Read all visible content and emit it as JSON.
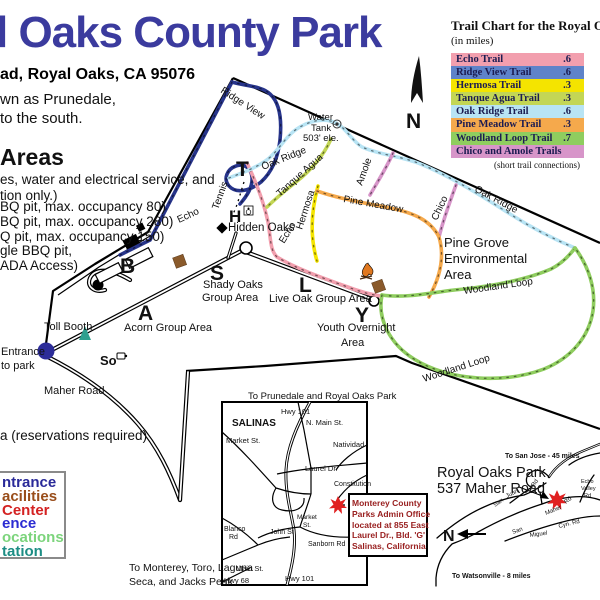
{
  "page": {
    "title": "l Oaks County Park",
    "address": "ad, Royal Oaks, CA 95076",
    "intro": [
      "wn as Prunedale,",
      "to the south."
    ],
    "areas_heading": "Areas",
    "areas_intro": [
      "es, water and electrical service, and",
      "tion only.)"
    ],
    "areas_items": [
      "BQ pit, max. occupancy 80)",
      "BQ pit, max. occupancy 280)",
      "Q pit, max. occupancy 150)",
      "gle BBQ pit,",
      "ADA Access)"
    ],
    "reservation_note": "a (reservations required)",
    "to_monterey": [
      "To Monterey, Toro, Laguna",
      "Seca, and Jacks Peak"
    ]
  },
  "trail_chart": {
    "title": "Trail Chart for the Royal Oak",
    "subtitle": "(in miles)",
    "rows": [
      {
        "name": "Echo Trail",
        "miles": ".6",
        "color": "#f29fae"
      },
      {
        "name": "Ridge View Trail",
        "miles": ".6",
        "color": "#5f83c9"
      },
      {
        "name": "Hermosa Trail",
        "miles": ".3",
        "color": "#f4e400"
      },
      {
        "name": "Tanque Agua Trail",
        "miles": ".3",
        "color": "#c3d655"
      },
      {
        "name": "Oak Ridge Trail",
        "miles": ".6",
        "color": "#b8e4f4"
      },
      {
        "name": "Pine Meadow Trail",
        "miles": ".3",
        "color": "#f5a94c"
      },
      {
        "name": "Woodland Loop Trail",
        "miles": ".7",
        "color": "#8fcd5f"
      },
      {
        "name": "Chico and Amole Trails",
        "miles": "",
        "color": "#d795c9"
      }
    ],
    "footnote": "(short trail connections)"
  },
  "legend": {
    "items": [
      {
        "label": "ntrance",
        "color": "#2a2a99"
      },
      {
        "label": "acilities",
        "color": "#994d1a"
      },
      {
        "label": "Center",
        "color": "#d42222"
      },
      {
        "label": "ence",
        "color": "#2b2bd2"
      },
      {
        "label": "ocations",
        "color": "#7cd47c"
      },
      {
        "label": "tation",
        "color": "#1d8d84"
      }
    ]
  },
  "map": {
    "labels": {
      "ridge_view": "Ridge View",
      "echo_a": "Echo",
      "echo_b": "Echo",
      "tennis": "Tennis",
      "oak_ridge_a": "Oak Ridge",
      "oak_ridge_b": "Oak Ridge",
      "tanque_agua": "Tanque Agua",
      "hermosa": "Hermosa",
      "amole": "Amole",
      "chico": "Chico",
      "pine_meadow": "Pine Meadow",
      "woodland_a": "Woodland Loop",
      "woodland_b": "Woodland Loop",
      "water_1": "Water",
      "water_2": "Tank",
      "water_3": "503' ele.",
      "letter_t": "T",
      "letter_b": "B",
      "letter_a": "A",
      "letter_s": "S",
      "letter_l": "L",
      "letter_y": "Y",
      "letter_h": "H",
      "letter_so": "So",
      "hidden_oaks": "Hidden Oaks",
      "toll_booth": "Toll Booth",
      "entrance_1": "Entrance",
      "entrance_2": "to park",
      "maher_road": "Maher Road",
      "acorn": "Acorn Group Area",
      "shady_1": "Shady Oaks",
      "shady_2": "Group Area",
      "live_oak": "Live Oak Group Area",
      "youth_1": "Youth Overnight",
      "youth_2": "Area",
      "pine_grove_1": "Pine Grove",
      "pine_grove_2": "Environmental",
      "pine_grove_3": "Area",
      "compass_n": "N"
    }
  },
  "salinas_inset": {
    "heading": "To Prunedale and Royal Oaks Park",
    "labels": {
      "salinas": "SALINAS",
      "hwy101_top": "Hwy 101",
      "n_main": "N. Main St.",
      "market_top": "Market St.",
      "natividad": "Natividad",
      "laurel": "Laurel Dr.",
      "constitution": "Constitution",
      "market_mid_1": "Market",
      "market_mid_2": "St.",
      "john": "John St",
      "blanco_1": "Blanco",
      "blanco_2": "Rd",
      "sanborn": "Sanborn Rd",
      "main": "Main St.",
      "hwy68": "Hwy 68",
      "hwy101_bottom": "Hwy 101"
    }
  },
  "admin_box": {
    "lines": [
      "Monterey County",
      "Parks Admin Office",
      "located at 855 East",
      "Laurel Dr., Bld. 'G'",
      "Salinas, California"
    ]
  },
  "right_inset": {
    "labels": {
      "to_san_jose": "To San Jose - 45 miles",
      "park_name": "Royal Oaks Park",
      "park_addr": "537 Maher Road",
      "to_watsonville": "To Watsonville - 8 miles",
      "n": "N",
      "san_a": "San",
      "juan": "Juan",
      "rd_a": "Rd",
      "maher": "Maher",
      "rd_b": "Rd",
      "echo_v1": "Echo",
      "echo_v2": "Valley",
      "echo_v3": "Rd",
      "san_b": "San",
      "miguel": "Miguel",
      "cyn_rd": "Cyn. Rd"
    }
  },
  "colors": {
    "title_blue": "#3b3b9e",
    "admin_text_red": "#992020",
    "star_red": "#e02020",
    "entrance_navy": "#2d2d99",
    "toll_booth_teal": "#2fa08f"
  }
}
